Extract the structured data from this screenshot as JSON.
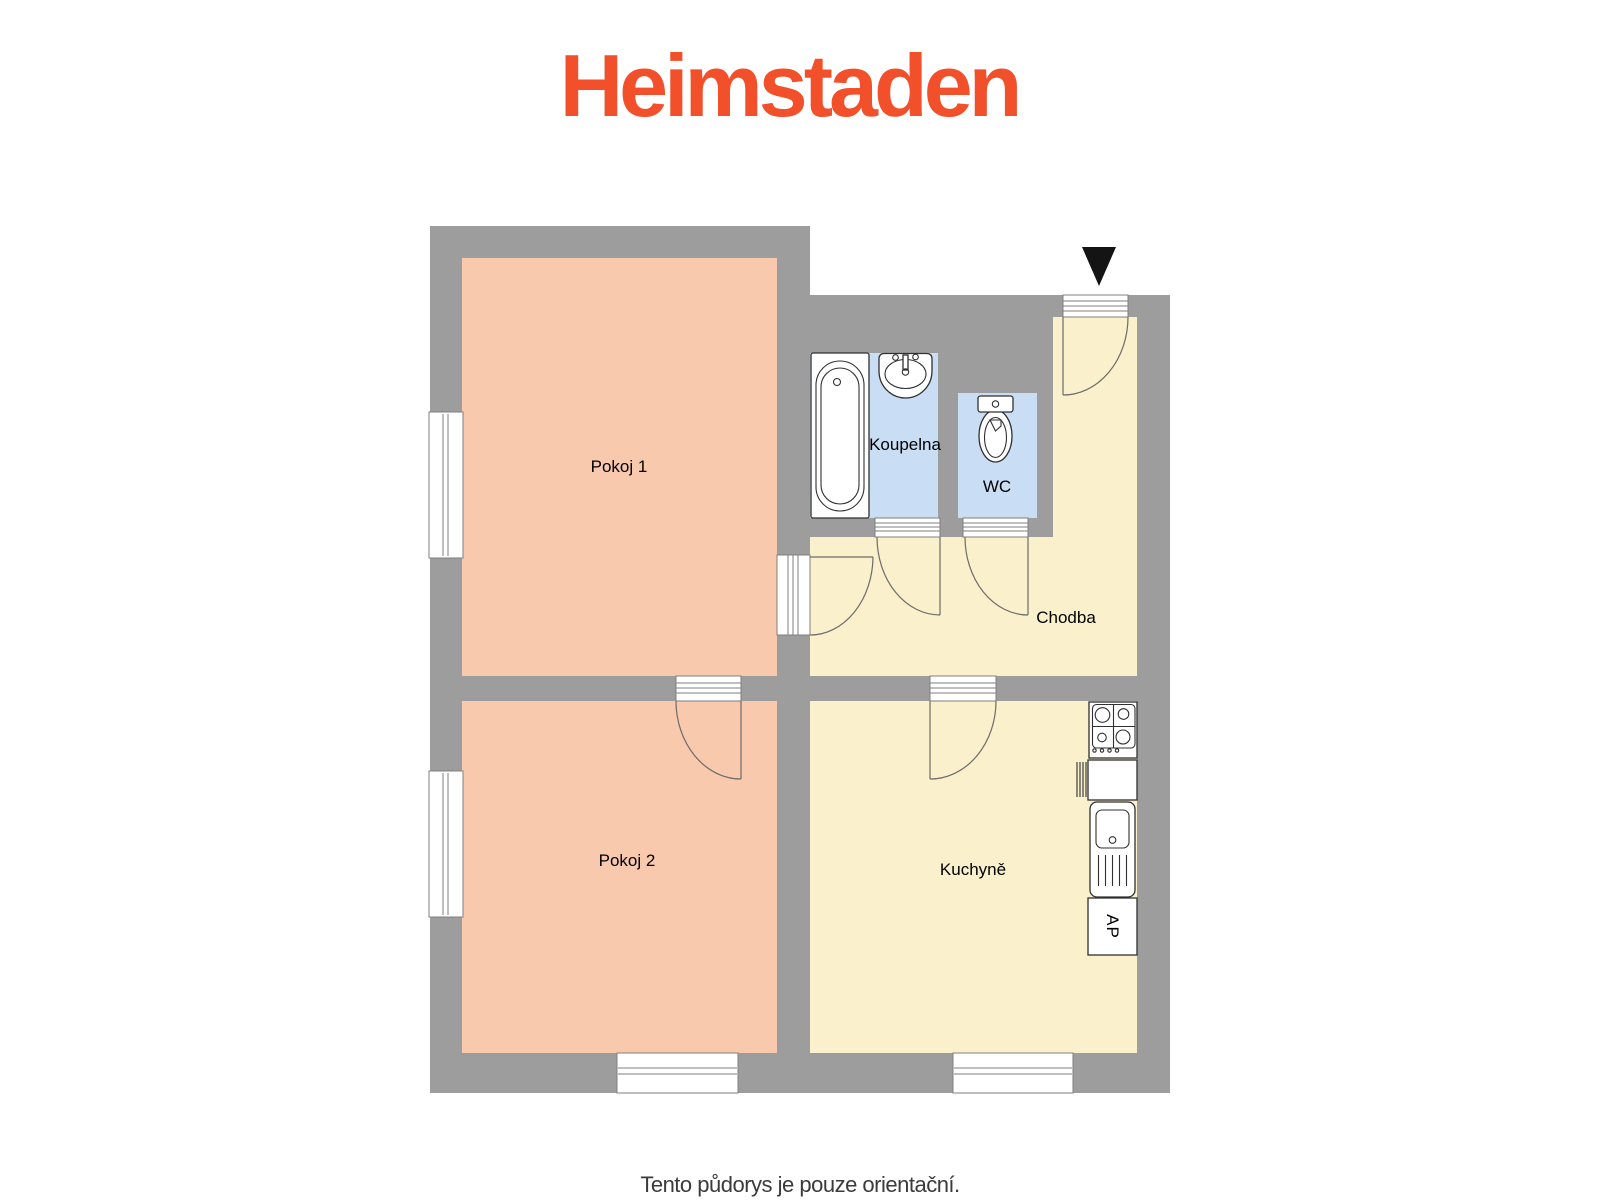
{
  "logo": {
    "text": "Heimstaden"
  },
  "plan": {
    "rooms": {
      "pokoj1": {
        "label": "Pokoj 1"
      },
      "pokoj2": {
        "label": "Pokoj 2"
      },
      "koupelna": {
        "label": "Koupelna"
      },
      "wc": {
        "label": "WC"
      },
      "chodba": {
        "label": "Chodba"
      },
      "kuchyne": {
        "label": "Kuchyně"
      }
    },
    "fixtures": {
      "dishwasher_label": "AP",
      "icons": [
        "bathtub-icon",
        "washbasin-icon",
        "toilet-icon",
        "stove-icon",
        "kitchen-sink-icon",
        "dishwasher-icon",
        "entrance-arrow-icon"
      ]
    }
  },
  "footer": {
    "disclaimer": "Tento půdorys je pouze orientační."
  },
  "colors": {
    "logo": "#f1502b",
    "wall": "#9d9d9d",
    "room_pink": "#f9c9ad",
    "room_cream": "#faf0cb",
    "room_blue": "#c9ddf5",
    "line_gray": "#7f7f7f",
    "door_arc": "#6b6b6b",
    "fixture_stroke": "#303030",
    "triangle": "#141414",
    "footer_text": "#3b3b3b"
  }
}
